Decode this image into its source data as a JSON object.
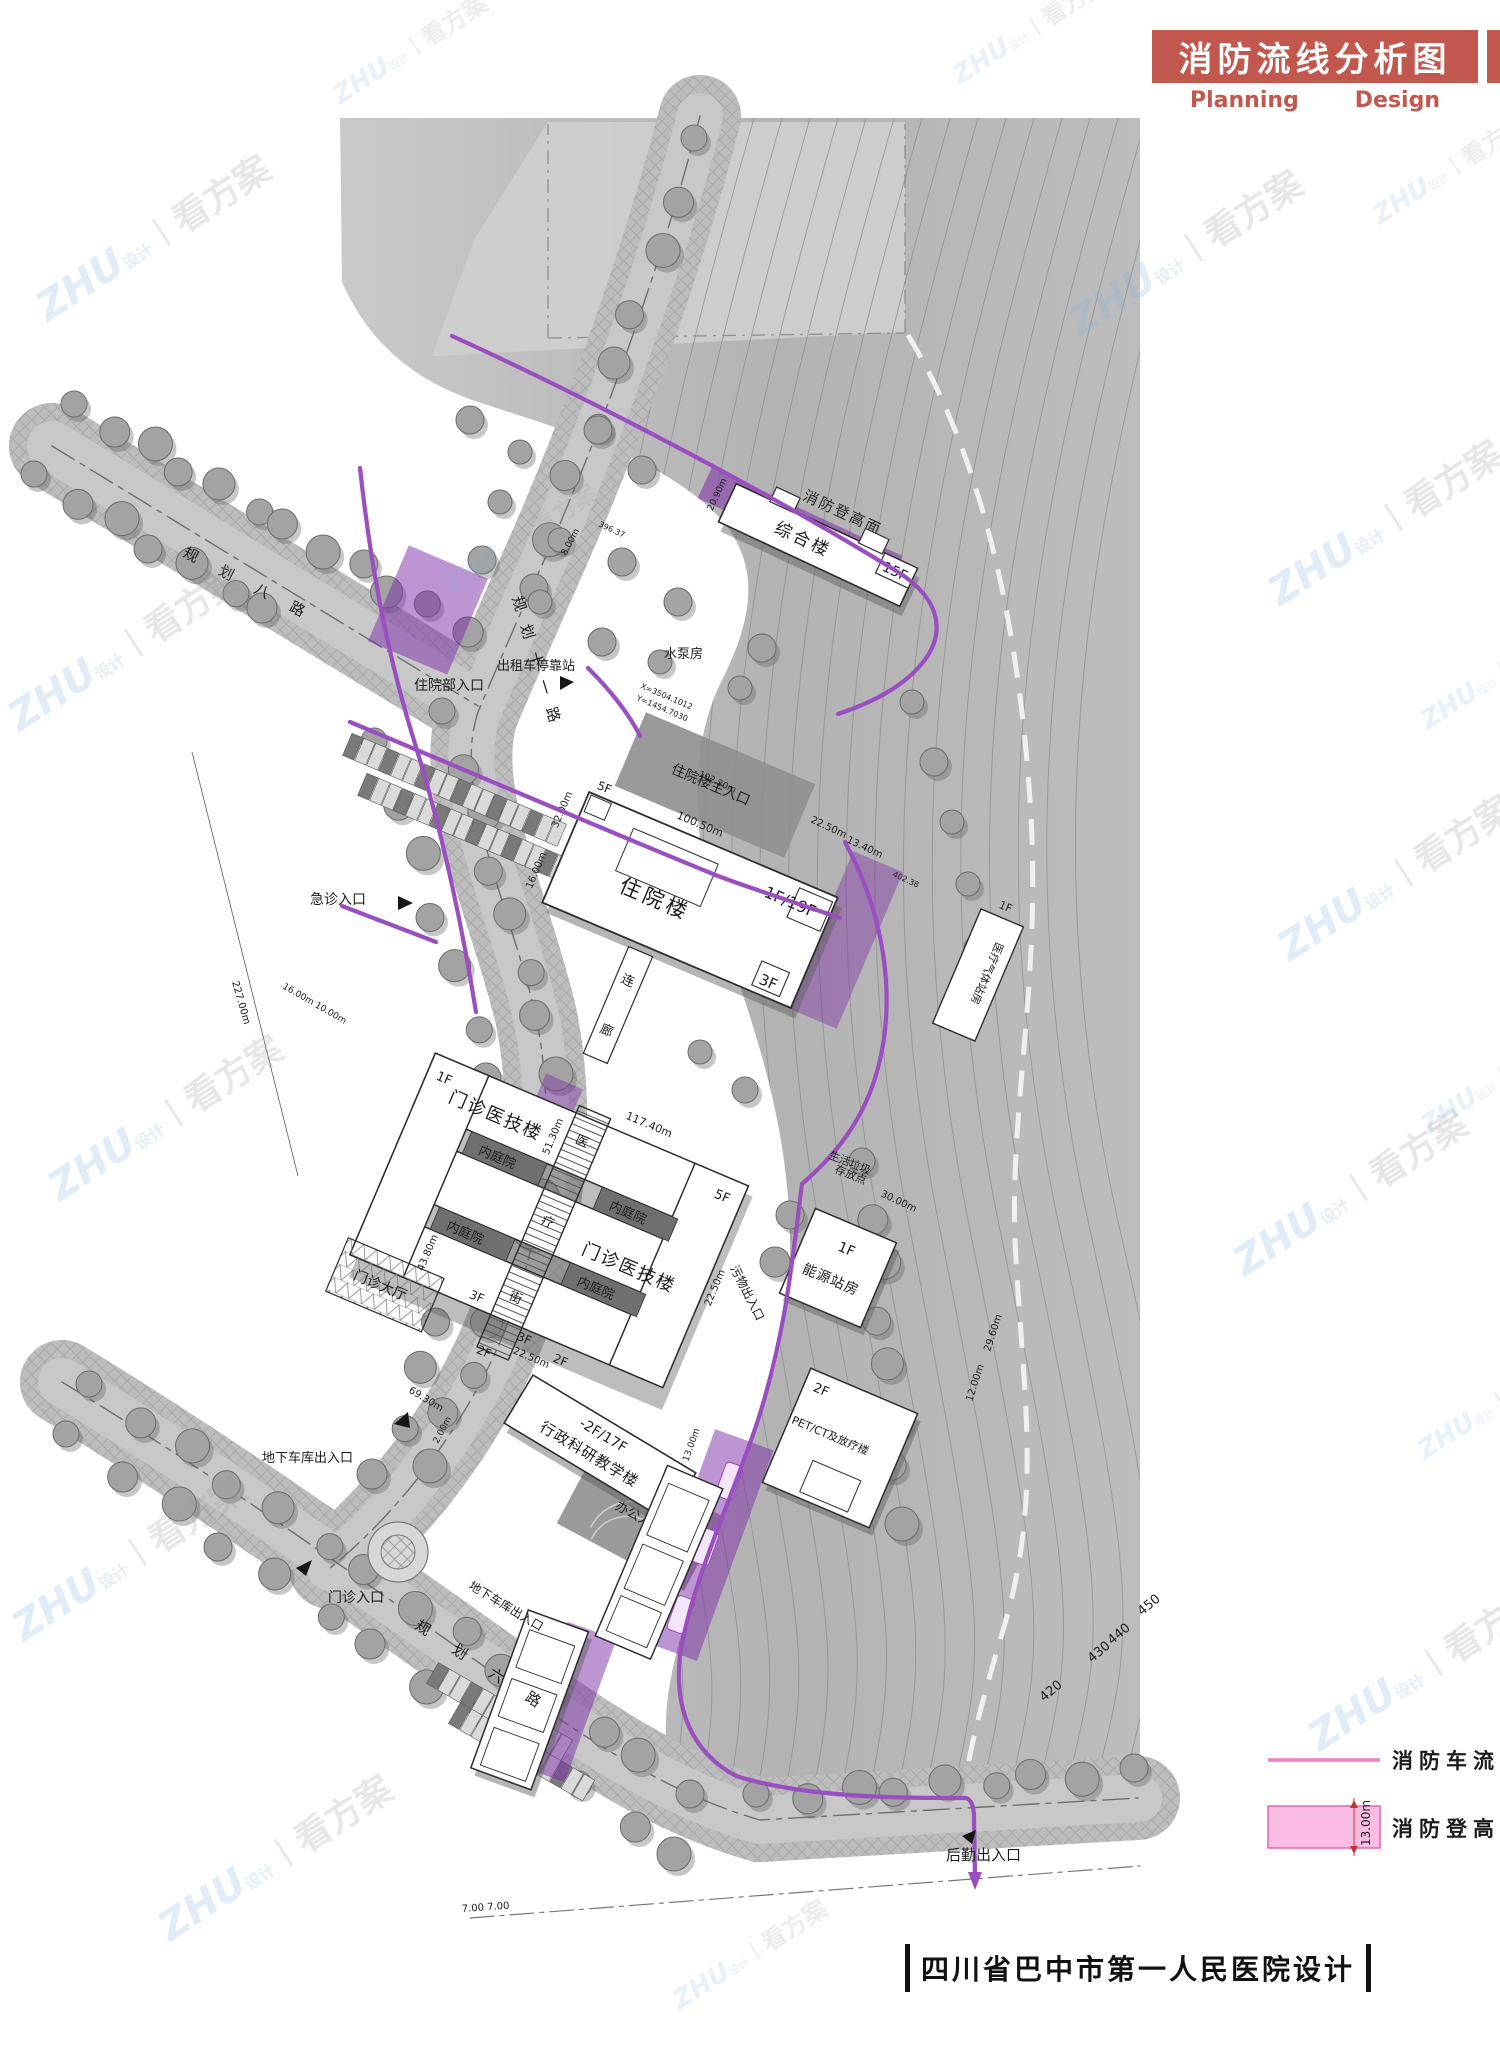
{
  "header": {
    "title": "消防流线分析图",
    "subtitle": {
      "left": "Planning",
      "right": "Design"
    }
  },
  "footer": {
    "project_title": "四川省巴中市第一人民医院设计"
  },
  "legend": {
    "fire_route_label": "消防车流线",
    "climb_label": "消防登高面",
    "climb_width": "13.00m"
  },
  "watermark": {
    "brand": "ZHU",
    "suffix": "设计",
    "sep": "丨",
    "name": "看方案"
  },
  "roads": {
    "road8": "规 划 八 路",
    "road6": "规 划 六 路",
    "road11": "规划十一路"
  },
  "buildings": {
    "zonghelou": {
      "name": "综合楼",
      "floors": "15F"
    },
    "zhuyuanlou": {
      "name": "住院楼",
      "floors": "-1F/19F",
      "podium": "3F"
    },
    "menzhen": {
      "name": "门诊医技楼",
      "f1": "1F",
      "f5": "5F",
      "f3": "3F",
      "f2": "2F"
    },
    "xingzheng": {
      "name": "行政科研教学楼",
      "floors": "-2F/17F"
    },
    "nengyuan": {
      "name": "能源站房",
      "floors": "1F"
    },
    "petct": {
      "name": "PET/CT及放疗楼",
      "floors": "2F"
    },
    "qiti": {
      "name": "医疗气体站房",
      "floors": "1F"
    },
    "shuibeng": {
      "name": "水泵房"
    },
    "lianlang": {
      "c1": "连",
      "c2": "廊"
    }
  },
  "site_labels": {
    "courtyard": "内庭院",
    "hall": "门诊大厅",
    "street1": "医",
    "street2": "疗",
    "street3": "街",
    "waste1": "生活垃圾",
    "waste2": "存放点",
    "climb_strip": "消防登高面"
  },
  "entrances": {
    "zhuyuanbu": "住院部入口",
    "zhuyuan_main": "住院楼主入口",
    "jizhen": "急诊入口",
    "menzhen": "门诊入口",
    "bangong": "办公入口",
    "houqin": "后勤出入口",
    "cheku": "地下车库出入口",
    "taxi": "出租车停靠站",
    "wuwu": "污物出入口"
  },
  "dimensions": {
    "d1": "100.50m",
    "d2": "117.40m",
    "d3": "227.00m",
    "d4": "69.30m",
    "d5": "20.90m",
    "d6": "32.00m",
    "d7": "16.00m",
    "d8": "51.30m",
    "d9": "43.80m",
    "d10": "22.50m",
    "d11": "13.40m",
    "d12": "30.00m",
    "d13": "29.60m",
    "d14": "12.00m",
    "d15": "16.00m 10.00m",
    "d16": "102.20m",
    "d17": "8.00m",
    "d18": "7.00  7.00",
    "d19": "2.00m",
    "d20": "13.00m"
  },
  "annotations": {
    "coordX": "X=3504.1012",
    "coordY": "Y=1454.7030",
    "elev1": "396.37",
    "elev2": "402.38"
  },
  "contours": {
    "c450": "450",
    "c440": "440",
    "c430": "430",
    "c420": "420"
  }
}
